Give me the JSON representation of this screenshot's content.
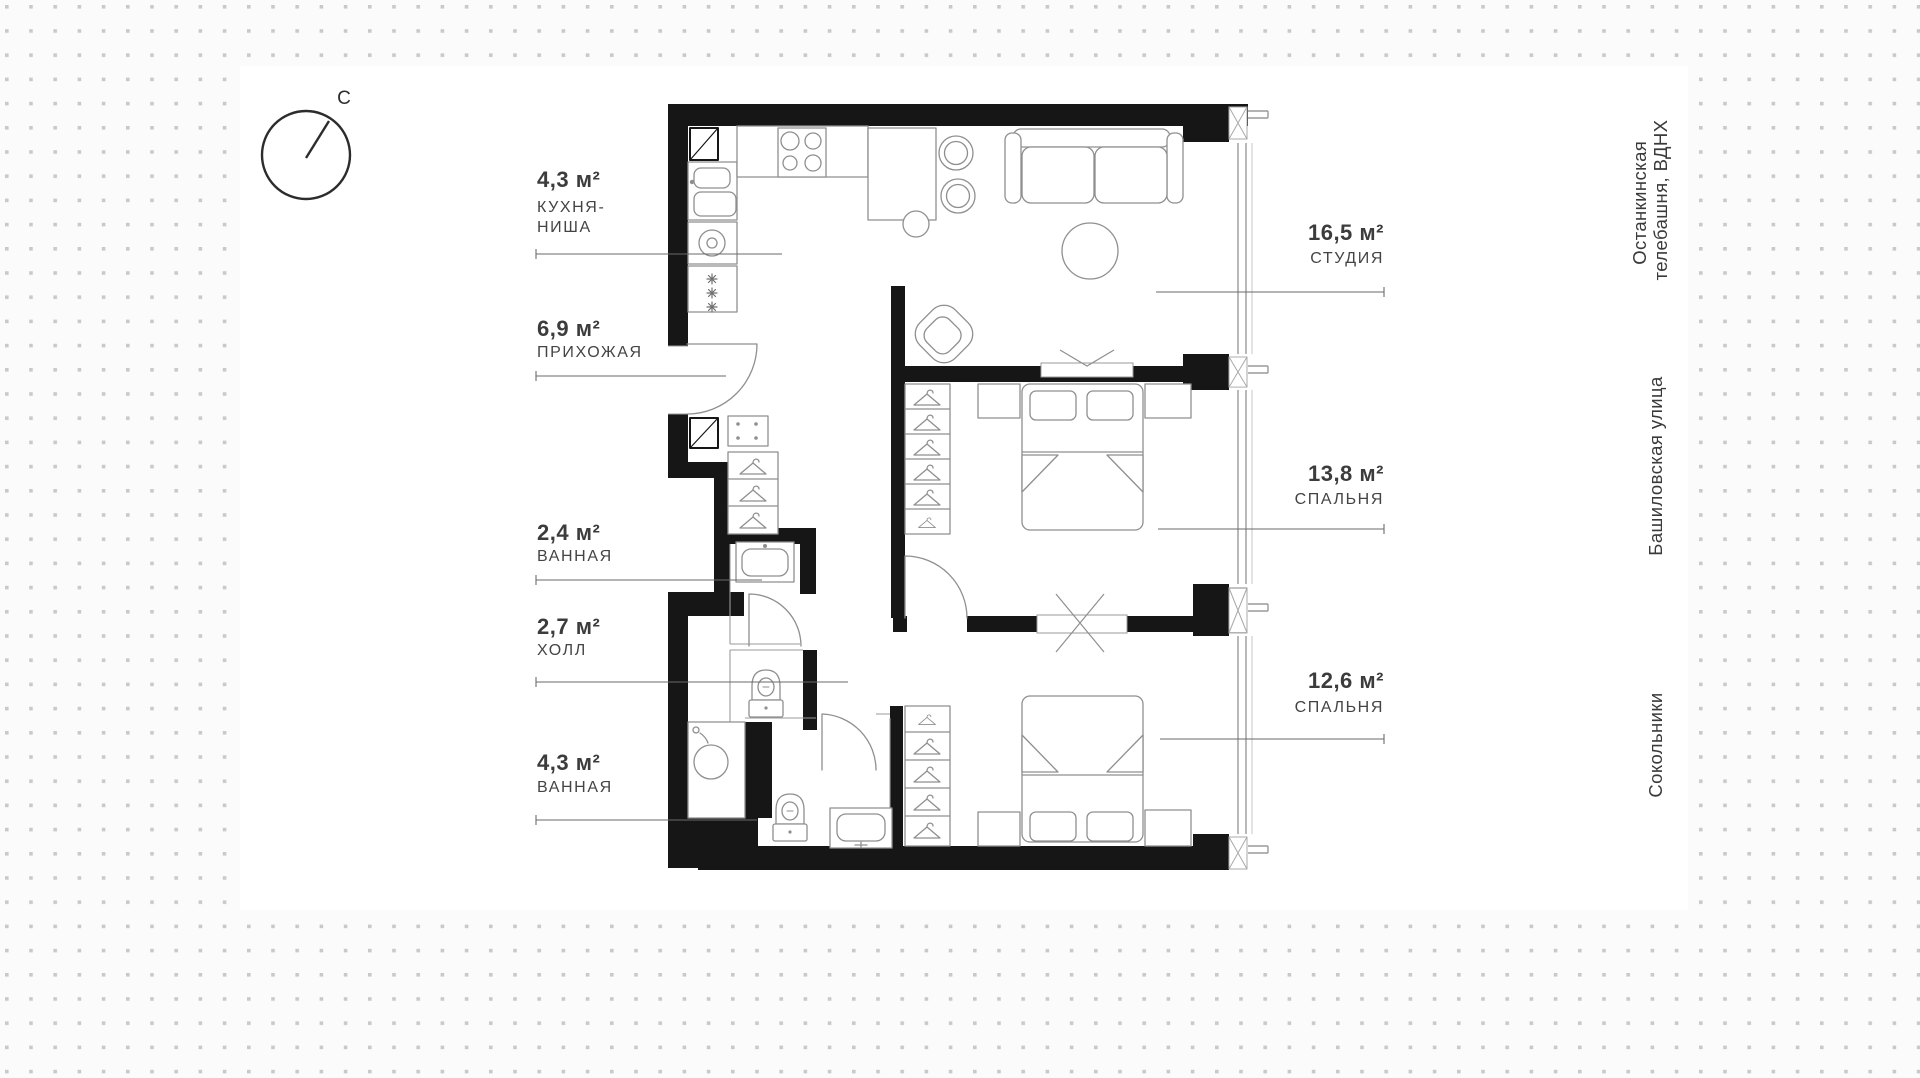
{
  "plan": {
    "title": "apartment floor plan",
    "compass": {
      "north_label": "С"
    },
    "rooms": [
      {
        "id": "kitchen-niche",
        "area": "4,3 м²",
        "name_line1": "КУХНЯ-",
        "name_line2": "НИША"
      },
      {
        "id": "hallway",
        "area": "6,9 м²",
        "name_line1": "ПРИХОЖАЯ",
        "name_line2": ""
      },
      {
        "id": "bathroom-1",
        "area": "2,4 м²",
        "name_line1": "ВАННАЯ",
        "name_line2": ""
      },
      {
        "id": "hall",
        "area": "2,7 м²",
        "name_line1": "ХОЛЛ",
        "name_line2": ""
      },
      {
        "id": "bathroom-2",
        "area": "4,3 м²",
        "name_line1": "ВАННАЯ",
        "name_line2": ""
      },
      {
        "id": "studio",
        "area": "16,5 м²",
        "name_line1": "СТУДИЯ",
        "name_line2": ""
      },
      {
        "id": "bedroom-1",
        "area": "13,8 м²",
        "name_line1": "СПАЛЬНЯ",
        "name_line2": ""
      },
      {
        "id": "bedroom-2",
        "area": "12,6 м²",
        "name_line1": "СПАЛЬНЯ",
        "name_line2": ""
      }
    ],
    "landmarks": [
      {
        "line1": "Останкинская",
        "line2": "телебашня, ВДНХ"
      },
      {
        "line1": "Башиловская улица",
        "line2": ""
      },
      {
        "line1": "Сокольники",
        "line2": ""
      }
    ],
    "colors": {
      "wall": "#161616",
      "furniture_line": "#8f8f8f",
      "label_text": "#3a3a3a",
      "background": "#fbfbfb",
      "backdrop": "#ffffff",
      "dot": "#c9c9c9"
    }
  }
}
